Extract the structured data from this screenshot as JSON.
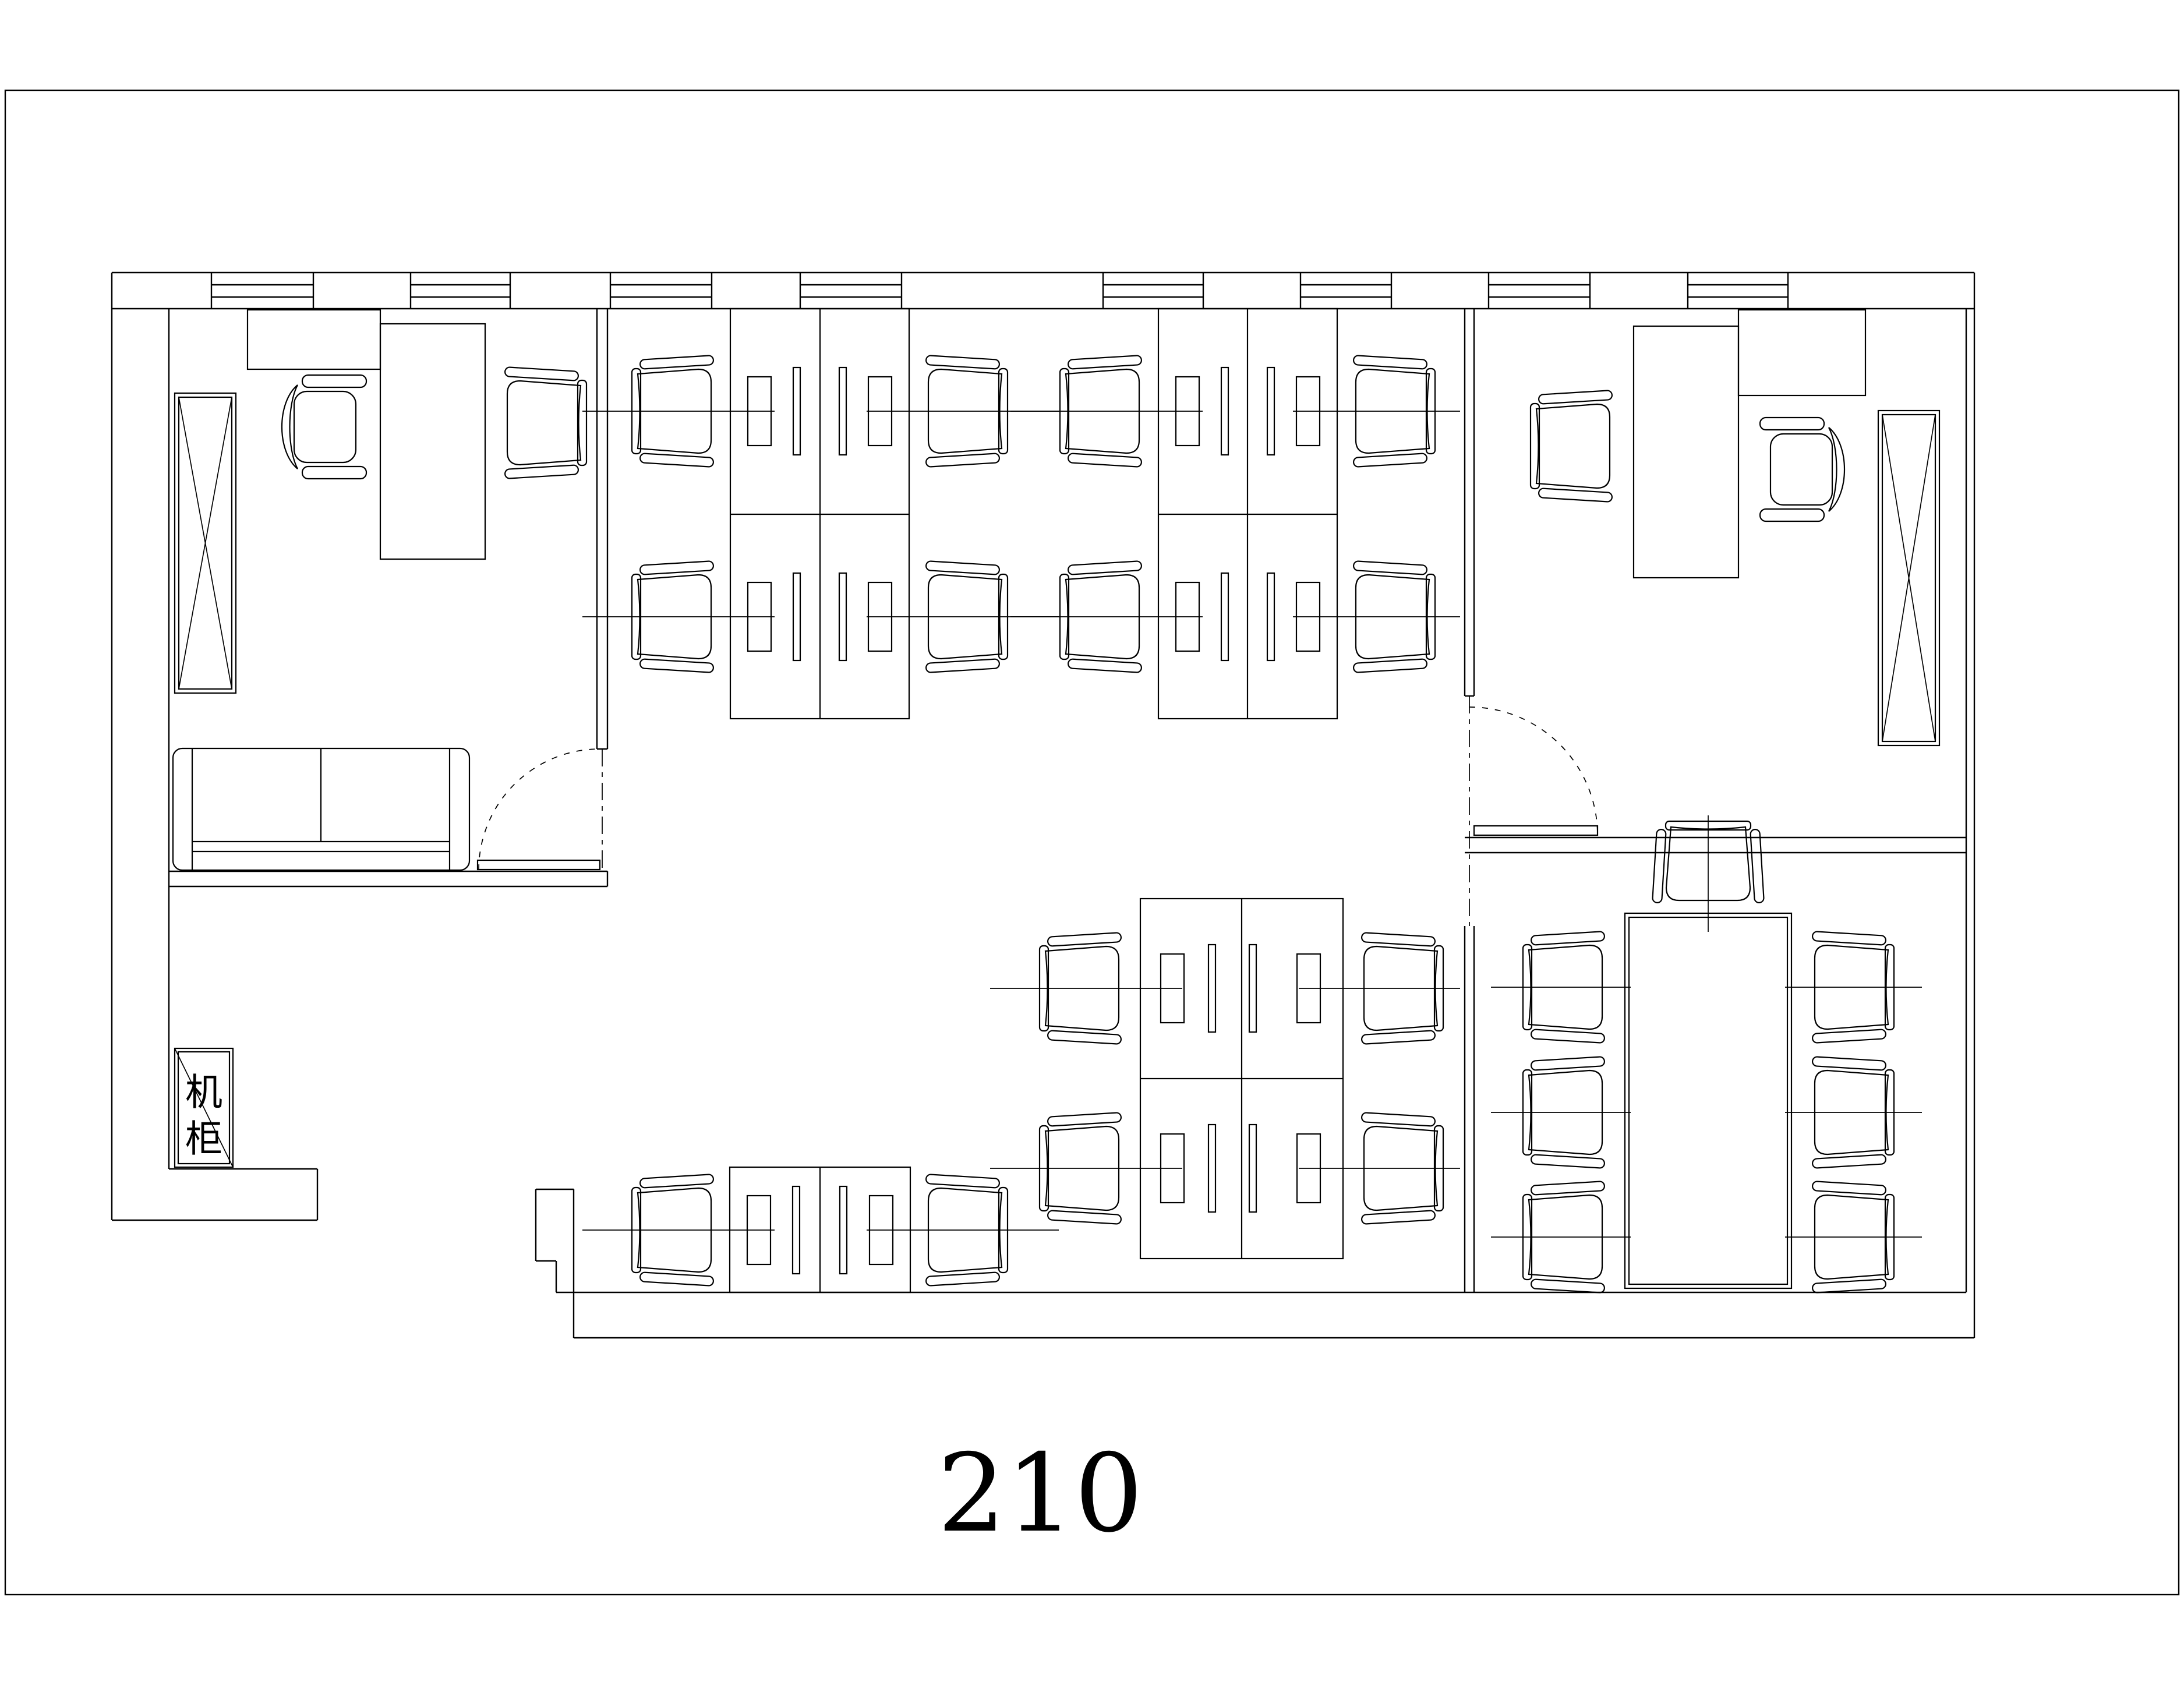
{
  "sheet": {
    "room_number": "210"
  },
  "cabinet": {
    "label": "机柜",
    "chars": [
      "机",
      "柜"
    ]
  },
  "colors": {
    "line": "#000000",
    "background": "#ffffff"
  }
}
